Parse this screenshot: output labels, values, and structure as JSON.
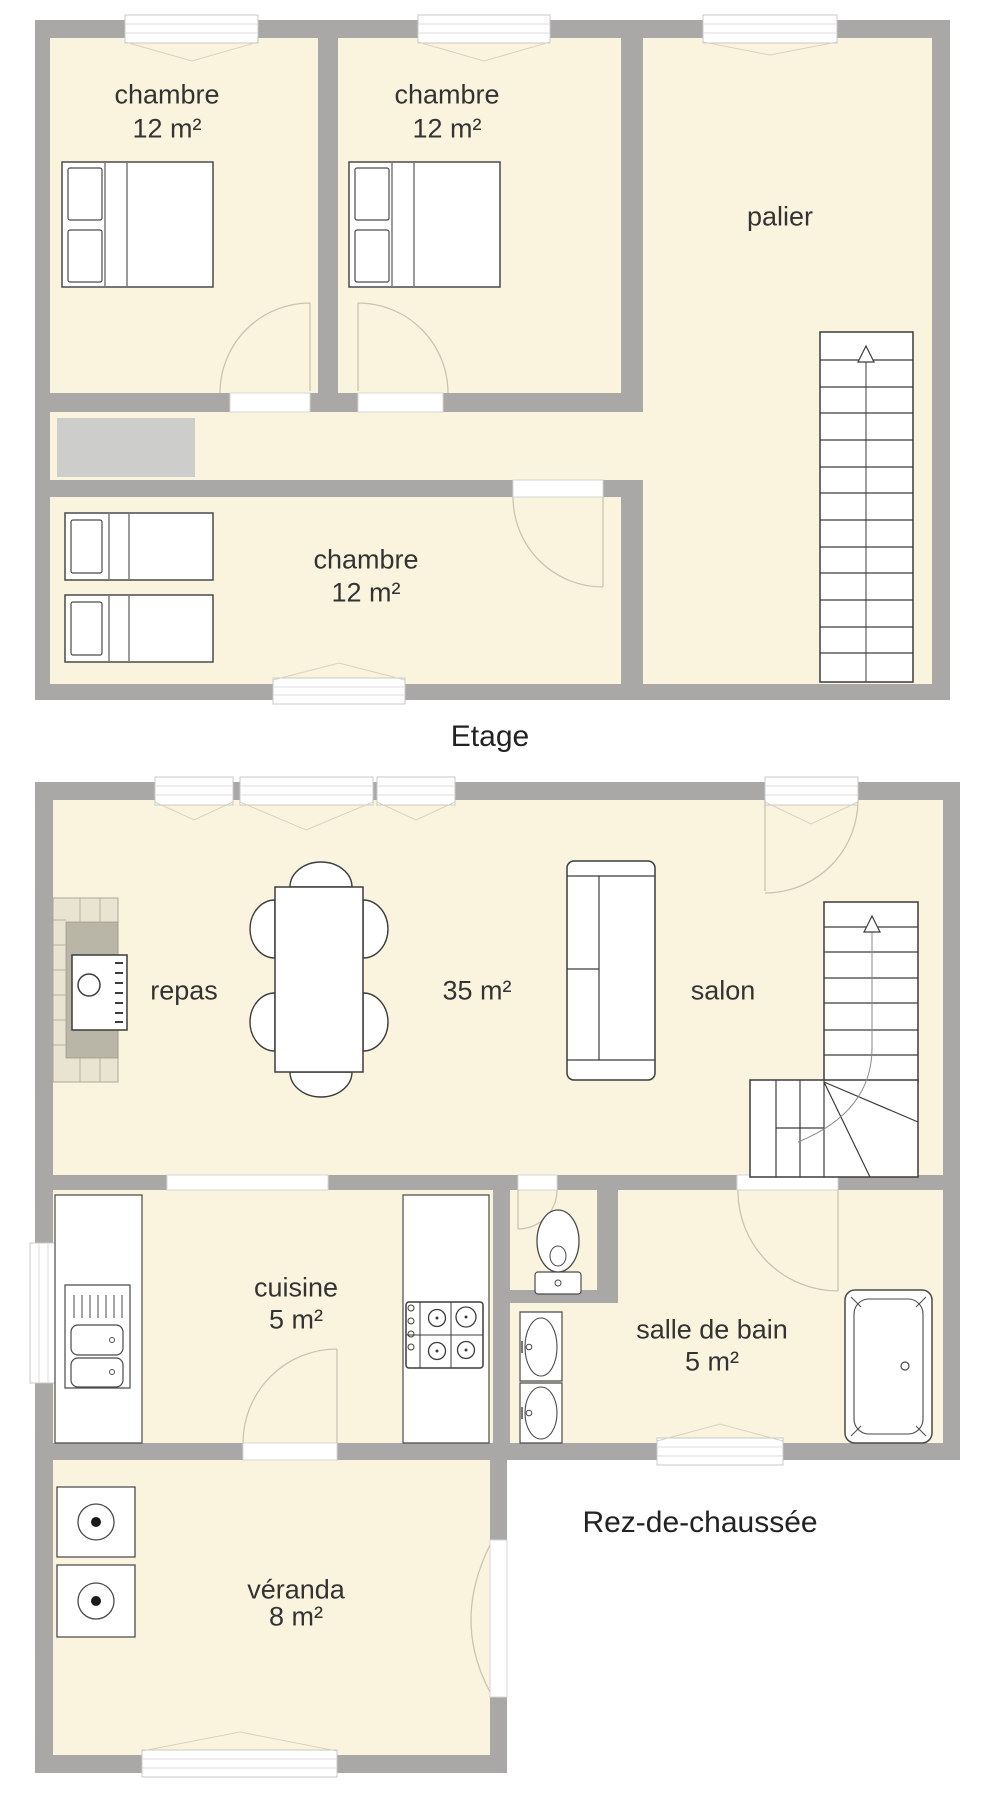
{
  "upper_floor": {
    "title": "Etage",
    "rooms": {
      "bedroom1": {
        "name": "chambre",
        "area": "12 m²"
      },
      "bedroom2": {
        "name": "chambre",
        "area": "12 m²"
      },
      "bedroom3": {
        "name": "chambre",
        "area": "12 m²"
      },
      "landing": {
        "name": "palier"
      }
    }
  },
  "ground_floor": {
    "title": "Rez-de-chaussée",
    "rooms": {
      "dining": {
        "name": "repas"
      },
      "living": {
        "name": "salon",
        "area": "35 m²"
      },
      "kitchen": {
        "name": "cuisine",
        "area": "5 m²"
      },
      "bathroom": {
        "name": "salle de bain",
        "area": "5 m²"
      },
      "veranda": {
        "name": "véranda",
        "area": "8 m²"
      }
    }
  },
  "colors": {
    "wall": "#a9a8a6",
    "floor": "#faf4df",
    "outline": "#3c3c3c"
  }
}
